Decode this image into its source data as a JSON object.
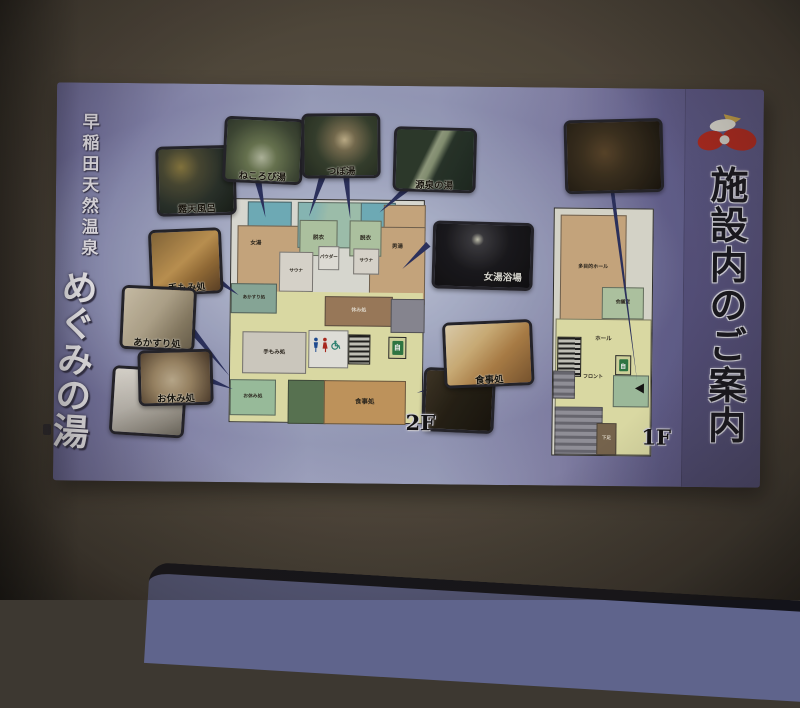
{
  "sign": {
    "brand_title_small": "早稲田天然温泉",
    "brand_title_main": "めぐみの湯",
    "panel_title": "施設内のご案内",
    "floor2_label": "2F",
    "floor1_label": "1F"
  },
  "photos": [
    {
      "name": "rotenburo-photo",
      "caption": "露天風呂"
    },
    {
      "name": "nekorobiyu-photo",
      "caption": "ねころび湯"
    },
    {
      "name": "tsuboyu-photo",
      "caption": "つぼ湯"
    },
    {
      "name": "gensen-photo",
      "caption": "源泉の湯"
    },
    {
      "name": "relax-room-photo",
      "caption": ""
    },
    {
      "name": "onnayu-photo",
      "caption": "女湯浴場"
    },
    {
      "name": "temomi-photo",
      "caption": "手もみ処"
    },
    {
      "name": "akasuri-photo",
      "caption": "あかすり処"
    },
    {
      "name": "oyasumi-photo",
      "caption": "お休み処"
    },
    {
      "name": "pillow-photo",
      "caption": ""
    },
    {
      "name": "shokuji-photo",
      "caption": "食事処"
    },
    {
      "name": "dark-room-photo",
      "caption": ""
    }
  ],
  "plan2f": {
    "rooms": {
      "roten": "露天",
      "onnayu": "女湯",
      "sauna_left": "サウナ",
      "datsui_left": "脱衣",
      "powder": "パウダー",
      "datsui_right": "脱衣",
      "sauna_right": "サウナ",
      "otokoyu": "男湯",
      "yasumi": "休み処",
      "temomi": "手もみ処",
      "akasuri": "あかすり処",
      "oyasumi": "お休み処",
      "shokuji": "食事処",
      "vending": "自"
    }
  },
  "plan1f": {
    "rooms": {
      "hall_main": "多目的ホール",
      "meeting": "会議室",
      "hall": "ホール",
      "front": "フロント",
      "vending": "自",
      "geta": "下足"
    }
  },
  "colors": {
    "arrow_navy": "#2b3263",
    "logo_red": "#b5291f",
    "sign_purple": "#55517e",
    "wall_brown": "#544c3f"
  }
}
